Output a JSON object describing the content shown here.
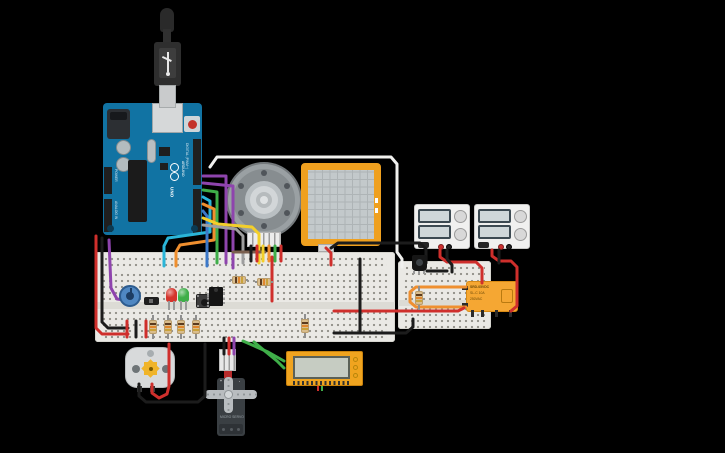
{
  "canvas": {
    "width": 725,
    "height": 453,
    "background": "#000000"
  },
  "palette": {
    "wire_red": "#cf2f2c",
    "wire_black": "#1c1c1c",
    "wire_green": "#3fae49",
    "wire_orange": "#ef8f2f",
    "wire_yellow": "#f3cf2a",
    "wire_cyan": "#2ab5d8",
    "wire_blue": "#3c78c8",
    "wire_purple": "#8e44ad",
    "wire_white": "#f0f0ee",
    "wire_gray": "#9e9e9e",
    "wire_brown": "#7a5f4e",
    "arduino_teal": "#1173a3",
    "breadboard": "#eae9e5",
    "relay_orange": "#f5a733",
    "frame_orange": "#efa01f"
  },
  "arduino": {
    "brand": "ARDUINO",
    "model": "UNO",
    "digital_label": "DIGITAL (PWM~)",
    "power_label": "POWER",
    "analog_label": "ANALOG IN"
  },
  "relay": {
    "line1": "SRD-05VDC",
    "line2": "SL-C 10A",
    "line3": "250VAC"
  },
  "servo": {
    "plus": "+",
    "pulse": "~",
    "minus": "-",
    "label": "MICRO SERVO"
  },
  "transistor": {
    "label": "N"
  },
  "circuit": {
    "wires": [
      {
        "name": "red-power-left",
        "color": "wire_red",
        "pts": [
          [
            96,
            236
          ],
          [
            96,
            328
          ],
          [
            102,
            334
          ],
          [
            128,
            334
          ]
        ]
      },
      {
        "name": "black-power-left",
        "color": "wire_black",
        "pts": [
          [
            102,
            238
          ],
          [
            102,
            322
          ],
          [
            108,
            328
          ],
          [
            128,
            328
          ]
        ]
      },
      {
        "name": "purple-analog",
        "color": "wire_purple",
        "pts": [
          [
            109,
            240
          ],
          [
            111,
            288
          ],
          [
            117,
            299
          ],
          [
            132,
            301
          ]
        ]
      },
      {
        "name": "white-signal",
        "color": "wire_white",
        "pts": [
          [
            210,
            167
          ],
          [
            217,
            157
          ],
          [
            391,
            157
          ],
          [
            397,
            164
          ],
          [
            397,
            252
          ],
          [
            402,
            259
          ],
          [
            402,
            267
          ]
        ]
      },
      {
        "name": "purple-d1",
        "color": "wire_purple",
        "pts": [
          [
            203,
            176
          ],
          [
            226,
            176
          ],
          [
            226,
            263
          ]
        ]
      },
      {
        "name": "purple-d2",
        "color": "wire_purple",
        "pts": [
          [
            203,
            183
          ],
          [
            233,
            186
          ],
          [
            233,
            268
          ]
        ]
      },
      {
        "name": "green-d",
        "color": "wire_green",
        "pts": [
          [
            203,
            190
          ],
          [
            217,
            192
          ],
          [
            217,
            263
          ]
        ]
      },
      {
        "name": "cyan-d",
        "color": "wire_cyan",
        "pts": [
          [
            203,
            197
          ],
          [
            210,
            201
          ],
          [
            210,
            232
          ],
          [
            168,
            238
          ],
          [
            164,
            246
          ],
          [
            164,
            266
          ]
        ]
      },
      {
        "name": "orange-d",
        "color": "wire_orange",
        "pts": [
          [
            203,
            204
          ],
          [
            214,
            209
          ],
          [
            214,
            240
          ],
          [
            180,
            245
          ],
          [
            176,
            252
          ],
          [
            176,
            266
          ]
        ]
      },
      {
        "name": "blue-d",
        "color": "wire_blue",
        "pts": [
          [
            203,
            211
          ],
          [
            207,
            216
          ],
          [
            207,
            266
          ]
        ]
      },
      {
        "name": "yellow-d",
        "color": "wire_yellow",
        "pts": [
          [
            203,
            218
          ],
          [
            218,
            224
          ],
          [
            252,
            227
          ],
          [
            259,
            234
          ],
          [
            259,
            263
          ]
        ]
      },
      {
        "name": "gray-d",
        "color": "wire_gray",
        "pts": [
          [
            203,
            225
          ],
          [
            236,
            229
          ],
          [
            243,
            236
          ],
          [
            243,
            263
          ]
        ]
      },
      {
        "name": "brown-rail",
        "color": "wire_brown",
        "pts": [
          [
            233,
            252
          ],
          [
            265,
            252
          ]
        ]
      },
      {
        "name": "red-fsr",
        "color": "wire_red",
        "pts": [
          [
            326,
            248
          ],
          [
            331,
            253
          ],
          [
            331,
            265
          ]
        ]
      },
      {
        "name": "black-fsr",
        "color": "wire_black",
        "pts": [
          [
            331,
            248
          ],
          [
            338,
            243
          ],
          [
            420,
            243
          ],
          [
            426,
            249
          ],
          [
            426,
            263
          ]
        ]
      },
      {
        "name": "red-psu1",
        "color": "wire_red",
        "pts": [
          [
            440,
            250
          ],
          [
            440,
            257
          ],
          [
            447,
            262
          ],
          [
            476,
            262
          ],
          [
            482,
            268
          ],
          [
            482,
            283
          ]
        ]
      },
      {
        "name": "black-psu1",
        "color": "wire_black",
        "pts": [
          [
            447,
            250
          ],
          [
            447,
            259
          ],
          [
            452,
            265
          ],
          [
            452,
            272
          ]
        ]
      },
      {
        "name": "red-psu2",
        "color": "wire_red",
        "pts": [
          [
            492,
            250
          ],
          [
            492,
            256
          ],
          [
            499,
            261
          ],
          [
            511,
            261
          ],
          [
            517,
            267
          ],
          [
            517,
            306
          ],
          [
            511,
            311
          ]
        ]
      },
      {
        "name": "black-psu2",
        "color": "wire_black",
        "pts": [
          [
            499,
            250
          ],
          [
            499,
            263
          ]
        ]
      },
      {
        "name": "orange-relay-loop",
        "color": "wire_orange",
        "pts": [
          [
            466,
            287
          ],
          [
            416,
            287
          ],
          [
            410,
            292
          ],
          [
            410,
            302
          ],
          [
            416,
            307
          ],
          [
            466,
            307
          ]
        ]
      },
      {
        "name": "red-main-relay",
        "color": "wire_red",
        "pts": [
          [
            334,
            311
          ],
          [
            458,
            311
          ],
          [
            464,
            308
          ]
        ]
      },
      {
        "name": "black-minibb-main",
        "color": "wire_black",
        "pts": [
          [
            334,
            333
          ],
          [
            406,
            333
          ],
          [
            413,
            327
          ],
          [
            413,
            319
          ]
        ]
      },
      {
        "name": "black-minibb-jumper",
        "color": "wire_black",
        "pts": [
          [
            427,
            271
          ],
          [
            447,
            271
          ]
        ]
      },
      {
        "name": "black-vertical-bb",
        "color": "wire_black",
        "pts": [
          [
            360,
            259
          ],
          [
            360,
            331
          ]
        ]
      },
      {
        "name": "red-vertical-bb",
        "color": "wire_red",
        "pts": [
          [
            272,
            257
          ],
          [
            272,
            301
          ]
        ]
      },
      {
        "name": "green-lcd-1",
        "color": "wire_green",
        "pts": [
          [
            243,
            341
          ],
          [
            268,
            352
          ],
          [
            284,
            361
          ]
        ]
      },
      {
        "name": "green-lcd-2",
        "color": "wire_green",
        "pts": [
          [
            254,
            342
          ],
          [
            277,
            361
          ],
          [
            284,
            368
          ]
        ]
      },
      {
        "name": "red-motor",
        "color": "wire_red",
        "pts": [
          [
            152,
            384
          ],
          [
            152,
            393
          ],
          [
            159,
            398
          ],
          [
            167,
            394
          ],
          [
            169,
            386
          ],
          [
            169,
            344
          ]
        ]
      },
      {
        "name": "black-motor",
        "color": "wire_black",
        "pts": [
          [
            139,
            384
          ],
          [
            139,
            396
          ],
          [
            146,
            402
          ],
          [
            198,
            402
          ],
          [
            205,
            396
          ],
          [
            205,
            344
          ]
        ]
      },
      {
        "name": "black-servo",
        "color": "wire_black",
        "pts": [
          [
            224,
            338
          ],
          [
            224,
            354
          ]
        ]
      },
      {
        "name": "red-servo",
        "color": "wire_red",
        "pts": [
          [
            229,
            338
          ],
          [
            229,
            354
          ]
        ]
      },
      {
        "name": "purple-servo",
        "color": "wire_purple",
        "pts": [
          [
            234,
            338
          ],
          [
            234,
            354
          ]
        ]
      },
      {
        "name": "red-rail-jumper-1",
        "color": "wire_red",
        "pts": [
          [
            127,
            321
          ],
          [
            127,
            337
          ]
        ]
      },
      {
        "name": "red-rail-jumper-2",
        "color": "wire_red",
        "pts": [
          [
            146,
            321
          ],
          [
            146,
            337
          ]
        ]
      },
      {
        "name": "black-rail-jumper",
        "color": "wire_black",
        "pts": [
          [
            136,
            321
          ],
          [
            136,
            337
          ]
        ]
      },
      {
        "name": "enc-black",
        "color": "wire_black",
        "pts": [
          [
            251,
            246
          ],
          [
            251,
            261
          ]
        ]
      },
      {
        "name": "enc-red",
        "color": "wire_red",
        "pts": [
          [
            257,
            246
          ],
          [
            257,
            261
          ]
        ]
      },
      {
        "name": "enc-yellow",
        "color": "wire_yellow",
        "pts": [
          [
            263,
            246
          ],
          [
            263,
            261
          ]
        ]
      },
      {
        "name": "enc-orange",
        "color": "wire_orange",
        "pts": [
          [
            269,
            246
          ],
          [
            269,
            261
          ]
        ]
      },
      {
        "name": "enc-green",
        "color": "wire_green",
        "pts": [
          [
            275,
            246
          ],
          [
            275,
            261
          ]
        ]
      },
      {
        "name": "enc-red-2",
        "color": "wire_red",
        "pts": [
          [
            281,
            246
          ],
          [
            281,
            261
          ]
        ]
      }
    ],
    "resistors": [
      {
        "x": 153,
        "y": 315,
        "len": 24,
        "dir": "v"
      },
      {
        "x": 168,
        "y": 315,
        "len": 24,
        "dir": "v"
      },
      {
        "x": 181,
        "y": 315,
        "len": 24,
        "dir": "v"
      },
      {
        "x": 196,
        "y": 315,
        "len": 24,
        "dir": "v"
      },
      {
        "x": 305,
        "y": 314,
        "len": 24,
        "dir": "v"
      },
      {
        "x": 419,
        "y": 286,
        "len": 24,
        "dir": "v"
      },
      {
        "x": 230,
        "y": 280,
        "len": 18,
        "dir": "h"
      },
      {
        "x": 255,
        "y": 282,
        "len": 18,
        "dir": "h"
      }
    ],
    "leds": [
      {
        "x": 166,
        "y": 288,
        "color": "#d4342c"
      },
      {
        "x": 178,
        "y": 288,
        "color": "#3fae49"
      }
    ]
  }
}
